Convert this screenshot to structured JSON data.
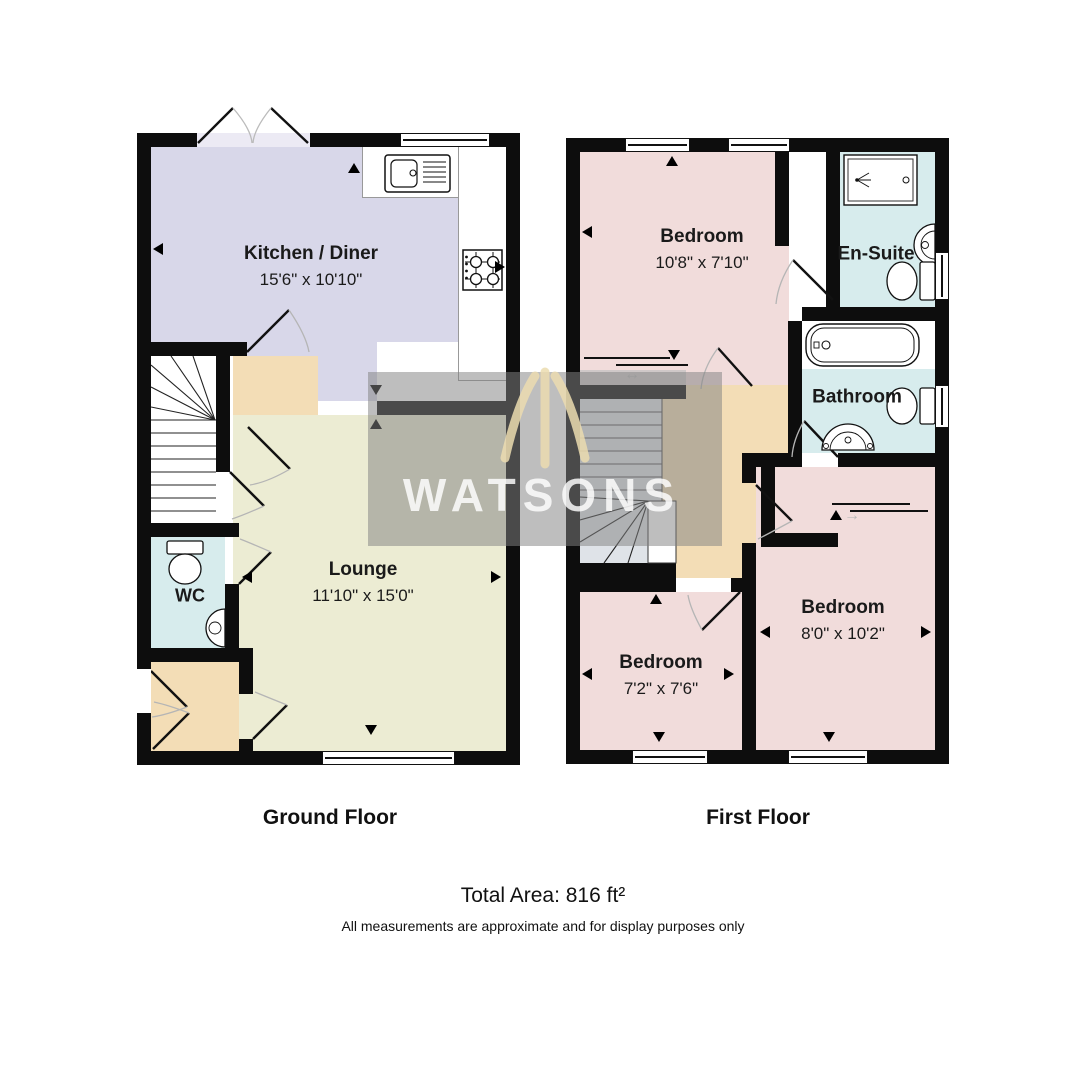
{
  "watermark": {
    "text": "WATSONS"
  },
  "footer": {
    "ground_caption": "Ground Floor",
    "first_caption": "First Floor",
    "total_area": "Total Area: 816 ft²",
    "disclaimer": "All measurements are approximate and for display purposes only"
  },
  "ground_floor": {
    "kitchen": {
      "name": "Kitchen / Diner",
      "dims": "15'6\" x 10'10\""
    },
    "lounge": {
      "name": "Lounge",
      "dims": "11'10\" x 15'0\""
    },
    "wc": {
      "name": "WC"
    }
  },
  "first_floor": {
    "bedroom1": {
      "name": "Bedroom",
      "dims": "10'8\" x 7'10\""
    },
    "ensuite": {
      "name": "En-Suite"
    },
    "bathroom": {
      "name": "Bathroom"
    },
    "bedroom2": {
      "name": "Bedroom",
      "dims": "8'0\" x 10'2\""
    },
    "bedroom3": {
      "name": "Bedroom",
      "dims": "7'2\" x 7'6\""
    }
  },
  "colors": {
    "wall": "#0d0d0d",
    "kitchen": "#d8d7e9",
    "lounge": "#ececd3",
    "wet_room": "#d7eced",
    "hall": "#f3ddb6",
    "bedroom": "#f1dcdb",
    "watermark_band": "#828282",
    "watermark_crown": "#ecdcb0"
  }
}
